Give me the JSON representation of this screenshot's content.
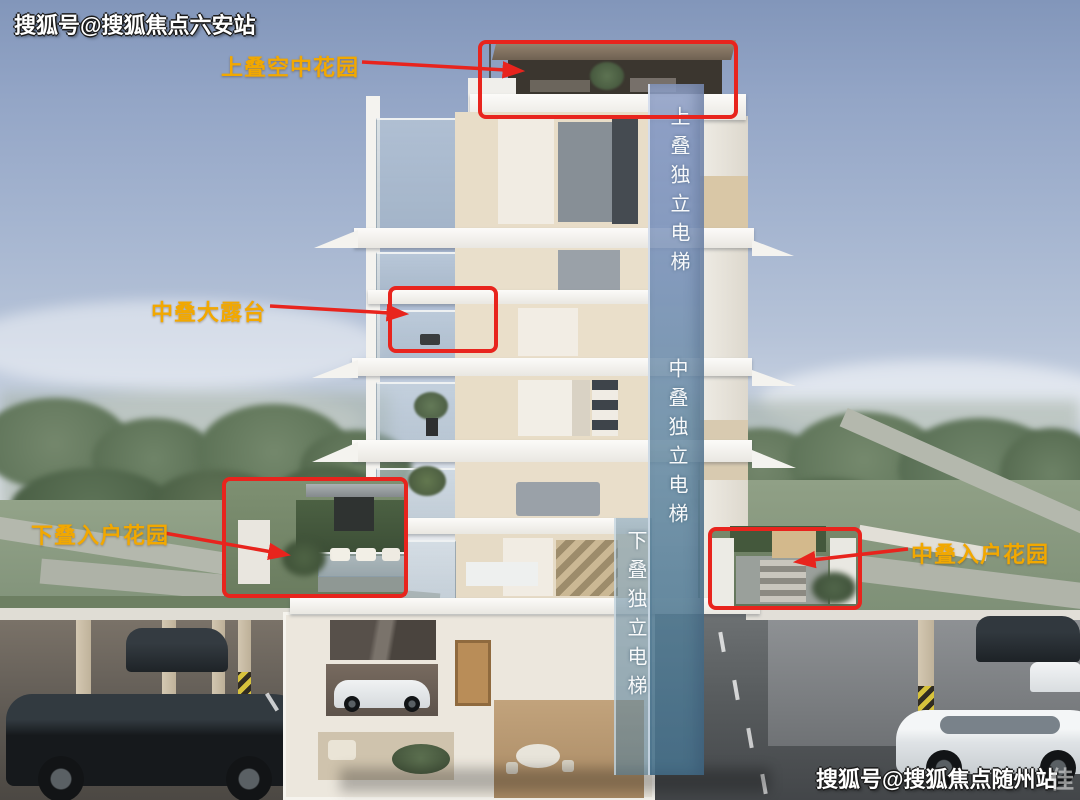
{
  "watermarks": {
    "top_left": "搜狐号@搜狐焦点六安站",
    "bottom_right": "搜狐号@搜狐焦点随州站",
    "corner_faint": "佳"
  },
  "callouts": {
    "sky_garden": {
      "label": "上叠空中花园"
    },
    "terrace": {
      "label": "中叠大露台"
    },
    "lower_entry_garden": {
      "label": "下叠入户花园"
    },
    "middle_entry_garden": {
      "label": "中叠入户花园"
    }
  },
  "elevator": {
    "upper": "上叠独立电梯",
    "middle": "中叠独立电梯",
    "lower": "下叠独立电梯"
  },
  "colors": {
    "annotation_red": "#e8241d",
    "label_yellow": "#f2a800",
    "shaft_blue_top": "#8b9cc2",
    "shaft_blue_bottom": "#4f7d95"
  }
}
